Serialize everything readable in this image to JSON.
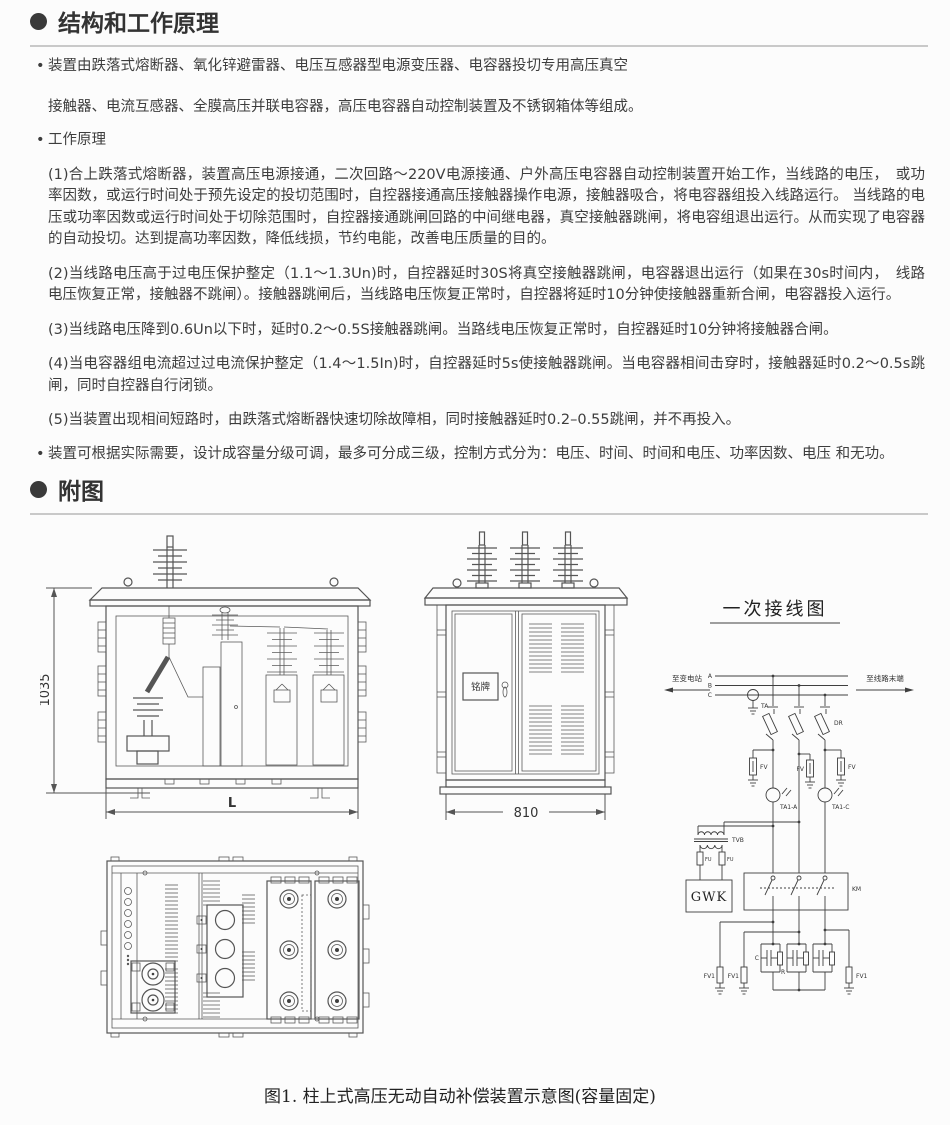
{
  "section1": {
    "title": "结构和工作原理"
  },
  "section2": {
    "title": "附图"
  },
  "content": {
    "bullet1_line1": "装置由跌落式熔断器、氧化锌避雷器、电压互感器型电源变压器、电容器投切专用高压真空",
    "bullet1_line2": "接触器、电流互感器、全膜高压并联电容器，高压电容器自动控制装置及不锈钢箱体等组成。",
    "bullet2": "工作原理",
    "para1": "(1)合上跌落式熔断器，装置高压电源接通，二次回路～220V电源接通、户外高压电容器自动控制装置开始工作，当线路的电压，　或功率因数，或运行时间处于预先设定的投切范围时，自控器接通高压接触器操作电源，接触器吸合，将电容器组投入线路运行。 当线路的电压或功率因数或运行时间处于切除范围时，自控器接通跳闸回路的中间继电器，真空接触器跳闸，将电容组退出运行。从而实现了电容器的自动投切。达到提高功率因数，降低线损，节约电能，改善电压质量的目的。",
    "para2": "(2)当线路电压高于过电压保护整定（1.1～1.3Un)时，自控器延时30S将真空接触器跳闸，电容器退出运行（如果在30s时间内，　线路电压恢复正常，接触器不跳闸）。接触器跳闸后，当线路电压恢复正常时，自控器将延时10分钟使接触器重新合闸，电容器投入运行。",
    "para3": "(3)当线路电压降到0.6Un以下时，延时0.2～0.5S接触器跳闸。当路线电压恢复正常时，自控器延时10分钟将接触器合闸。",
    "para4": "(4)当电容器组电流超过过电流保护整定（1.4～1.5In)时，自控器延时5s使接触器跳闸。当电容器相间击穿时，接触器延时0.2～0.5s跳闸，同时自控器自行闭锁。",
    "para5": "(5)当装置出现相间短路时，由跌落式熔断器快速切除故障相，同时接触器延时0.2–0.55跳闸，并不再投入。",
    "bullet3": "装置可根据实际需要，设计成容量分级可调，最多可分成三级，控制方式分为：电压、时间、时间和电压、功率因数、电压 和无功。"
  },
  "figures": {
    "front_view": {
      "height_dim": "1035",
      "width_dim": "L"
    },
    "side_view": {
      "width_dim": "810",
      "nameplate": "铭牌"
    },
    "schematic": {
      "title": "一次接线图",
      "to_substation": "至变电站",
      "to_line_end": "至线路末端",
      "phase_a": "A",
      "phase_b": "B",
      "phase_c": "C",
      "ta": "TA",
      "dr": "DR",
      "fv": "FV",
      "ta1_a": "TA1-A",
      "ta1_c": "TA1-C",
      "tvb": "TVB",
      "fu": "FU",
      "gwk": "GWK",
      "km": "KM",
      "c": "C",
      "r": "R",
      "fv1": "FV1"
    },
    "caption": "图1. 柱上式高压无动自动补偿装置示意图(容量固定)"
  }
}
